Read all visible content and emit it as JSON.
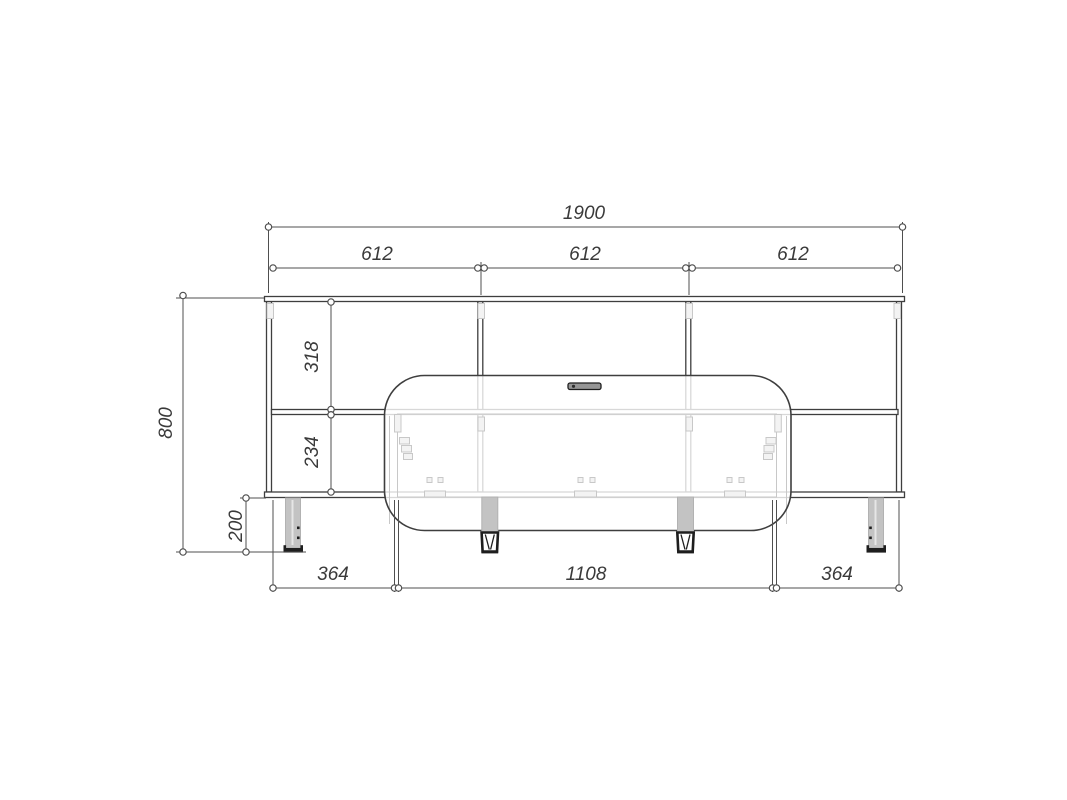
{
  "drawing": {
    "dimensions": {
      "overall_width": "1900",
      "bay_widths": [
        "612",
        "612",
        "612"
      ],
      "overall_height": "800",
      "upper_section": "318",
      "lower_section": "234",
      "leg_height": "200",
      "bottom_left": "364",
      "bottom_center": "1108",
      "bottom_right": "364"
    },
    "colors": {
      "line_dark": "#3e3e3e",
      "line_dim": "#4f4f4f",
      "line_light": "#c8c8c8",
      "fill_gray": "#c3c3c3",
      "fill_dark": "#1e1e1e",
      "text": "#3a3a3a",
      "background": "#ffffff"
    }
  }
}
